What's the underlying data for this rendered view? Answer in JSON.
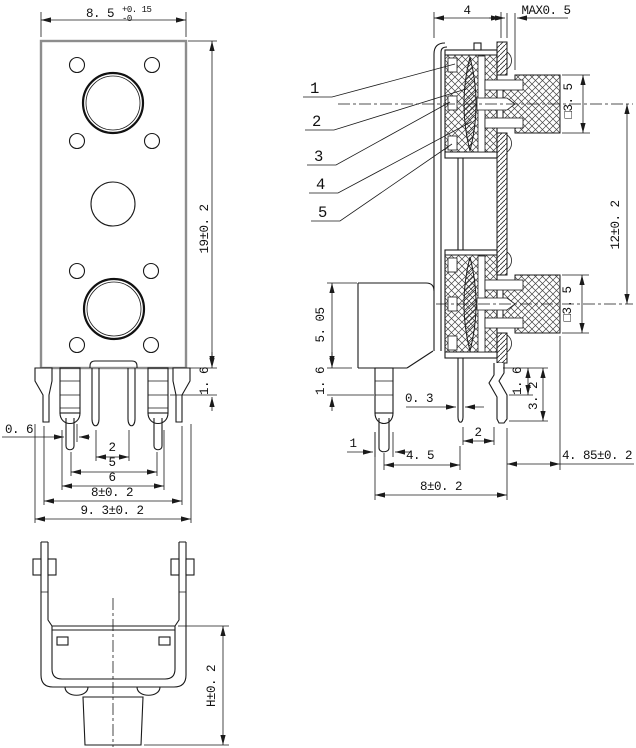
{
  "drawing": {
    "front_view": {
      "width": "8. 5",
      "width_tol_up": "+0. 15",
      "width_tol_dn": "-0",
      "height": "19±0. 2",
      "flange_lip": "1. 6",
      "pin_width": "0. 6",
      "pitch_2": "2",
      "pitch_5": "5",
      "pitch_6": "6",
      "pitch_8": "8±0. 2",
      "overall_width": "9. 3±0. 2"
    },
    "side_view": {
      "callouts": [
        "1",
        "2",
        "3",
        "4",
        "5"
      ],
      "depth": "4",
      "gap_max": "MAX0. 5",
      "square_upper": "□3. 5",
      "square_lower": "□3. 5",
      "jack_pitch": "12±0. 2",
      "body_height": "5. 05",
      "lip_left": "1. 6",
      "pin_width": "0. 3",
      "leg_segment": "1. 6",
      "leg_length": "3. 2",
      "pin_pitch": "2",
      "leg_width": "1",
      "pitch_4_5": "4. 5",
      "shaft_offset": "4. 85±0. 2",
      "leg_span": "8±0. 2"
    },
    "bottom_view": {
      "height": "H±0. 2"
    }
  }
}
